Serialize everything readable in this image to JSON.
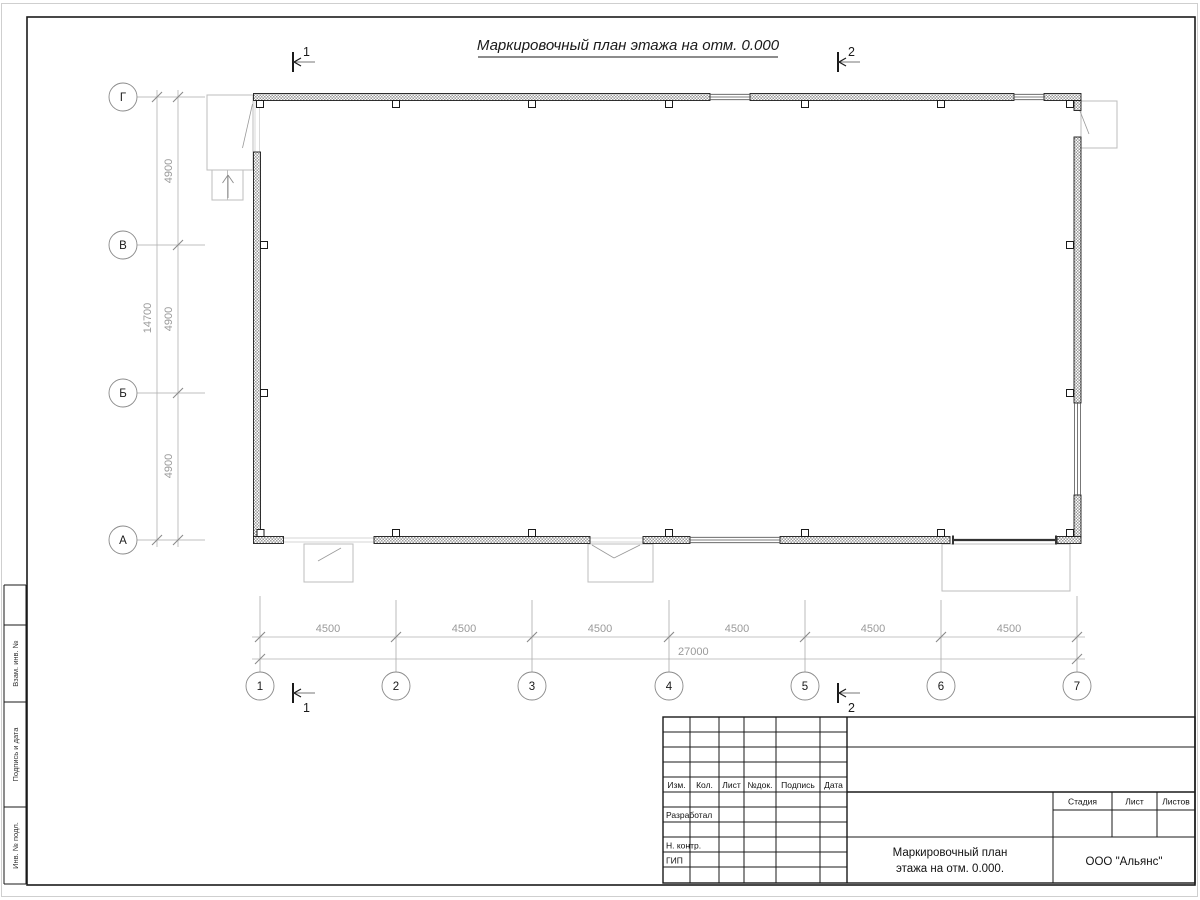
{
  "title": "Маркировочный план этажа на отм. 0.000",
  "plan": {
    "axes": {
      "columns": [
        "1",
        "2",
        "3",
        "4",
        "5",
        "6",
        "7"
      ],
      "rows": [
        "Г",
        "В",
        "Б",
        "А"
      ]
    },
    "dimensions": {
      "left_segments": [
        "4900",
        "4900",
        "4900"
      ],
      "left_total": "14700",
      "bottom_segments": [
        "4500",
        "4500",
        "4500",
        "4500",
        "4500",
        "4500"
      ],
      "bottom_total": "27000"
    },
    "section_marks": {
      "top": [
        "1",
        "2"
      ],
      "bottom": [
        "1",
        "2"
      ]
    }
  },
  "titleblock": {
    "header_cols": [
      "Изм.",
      "Кол.",
      "Лист",
      "№док.",
      "Подпись",
      "Дата"
    ],
    "sign_rows": [
      "Разработал",
      "Н. контр.",
      "ГИП"
    ],
    "stage_cols": [
      "Стадия",
      "Лист",
      "Листов"
    ],
    "doc_title_line1": "Маркировочный план",
    "doc_title_line2": "этажа на отм. 0.000.",
    "company": "ООО \"Альянс\""
  },
  "frame_side_strip": {
    "labels": [
      "Взам. инв. №",
      "Подпись и дата",
      "Инв. № подл."
    ]
  },
  "colors": {
    "line": "#1a1a1a",
    "dimension": "#9a9a9a",
    "porch": "#bdbdbd",
    "background": "#ffffff"
  }
}
